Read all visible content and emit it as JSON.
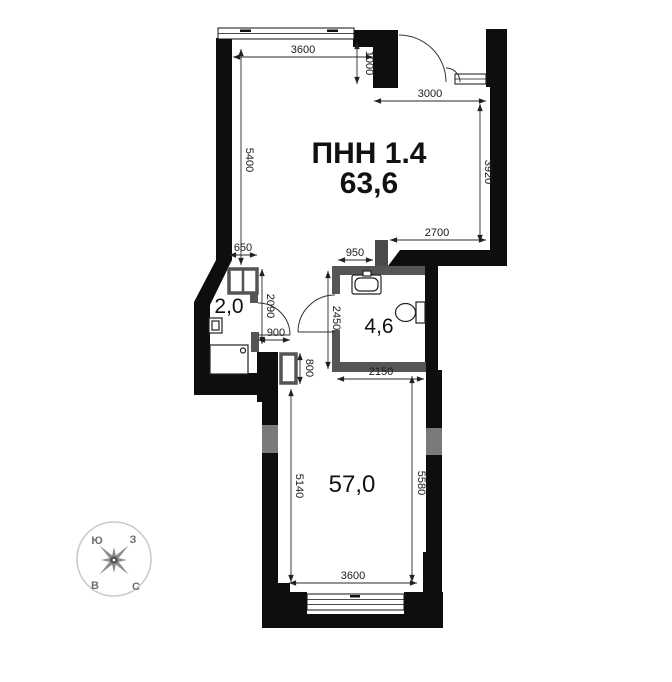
{
  "plan": {
    "unit_code": "ПНН 1.4",
    "unit_area": "63,6",
    "rooms": {
      "wc": "2,0",
      "bathroom": "4,6",
      "main": "57,0"
    },
    "dimensions": {
      "top_window": "3600",
      "entry_depth": "1000",
      "entry_width": "3000",
      "upper_left_height": "5400",
      "upper_right_height": "3920",
      "upper_bottom_width": "2700",
      "shaft_width": "650",
      "bath_wall": "950",
      "wc_height": "2090",
      "bath_height": "2450",
      "door_width": "900",
      "duct_height": "800",
      "bath_width": "2150",
      "lower_left_height": "5140",
      "lower_right_height": "5580",
      "lower_window": "3600"
    },
    "compass": {
      "top_left": "Ю",
      "top_right": "З",
      "bottom_left": "В",
      "bottom_right": "С"
    }
  },
  "colors": {
    "wall": "#0e0e0e",
    "partition": "#555555",
    "wall_insert": "#7a7a7a",
    "pier": "#4a4a4a",
    "dimension": "#2a2a2a",
    "compass": "#8e8e8e",
    "background": "#ffffff"
  }
}
